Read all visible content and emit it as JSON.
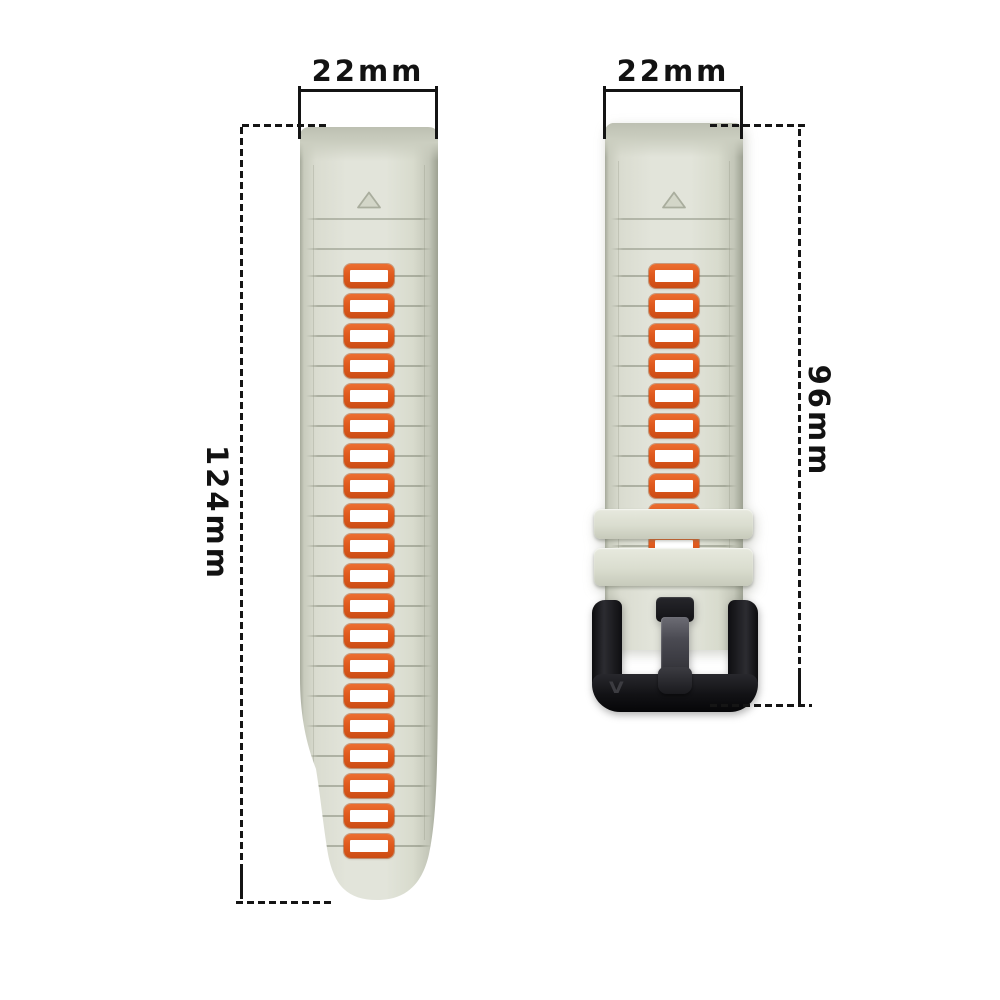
{
  "annotations": {
    "long_strap": {
      "width_label": "22mm",
      "length_label": "124mm"
    },
    "short_strap": {
      "width_label": "22mm",
      "length_label": "96mm"
    }
  },
  "long_strap": {
    "slot_count": 20,
    "pre_groove_count": 2
  },
  "short_strap": {
    "slot_count": 10,
    "pre_groove_count": 2,
    "keeper_count": 2
  },
  "buckle": {
    "logo": "V"
  },
  "colors": {
    "strap-base": "#e2e4da",
    "strap-edge": "#b4b8a9",
    "slot-orange": "#e05a1e",
    "slot-inner": "#ffffff",
    "buckle-black": "#141417",
    "annotation-ink": "#141414"
  }
}
